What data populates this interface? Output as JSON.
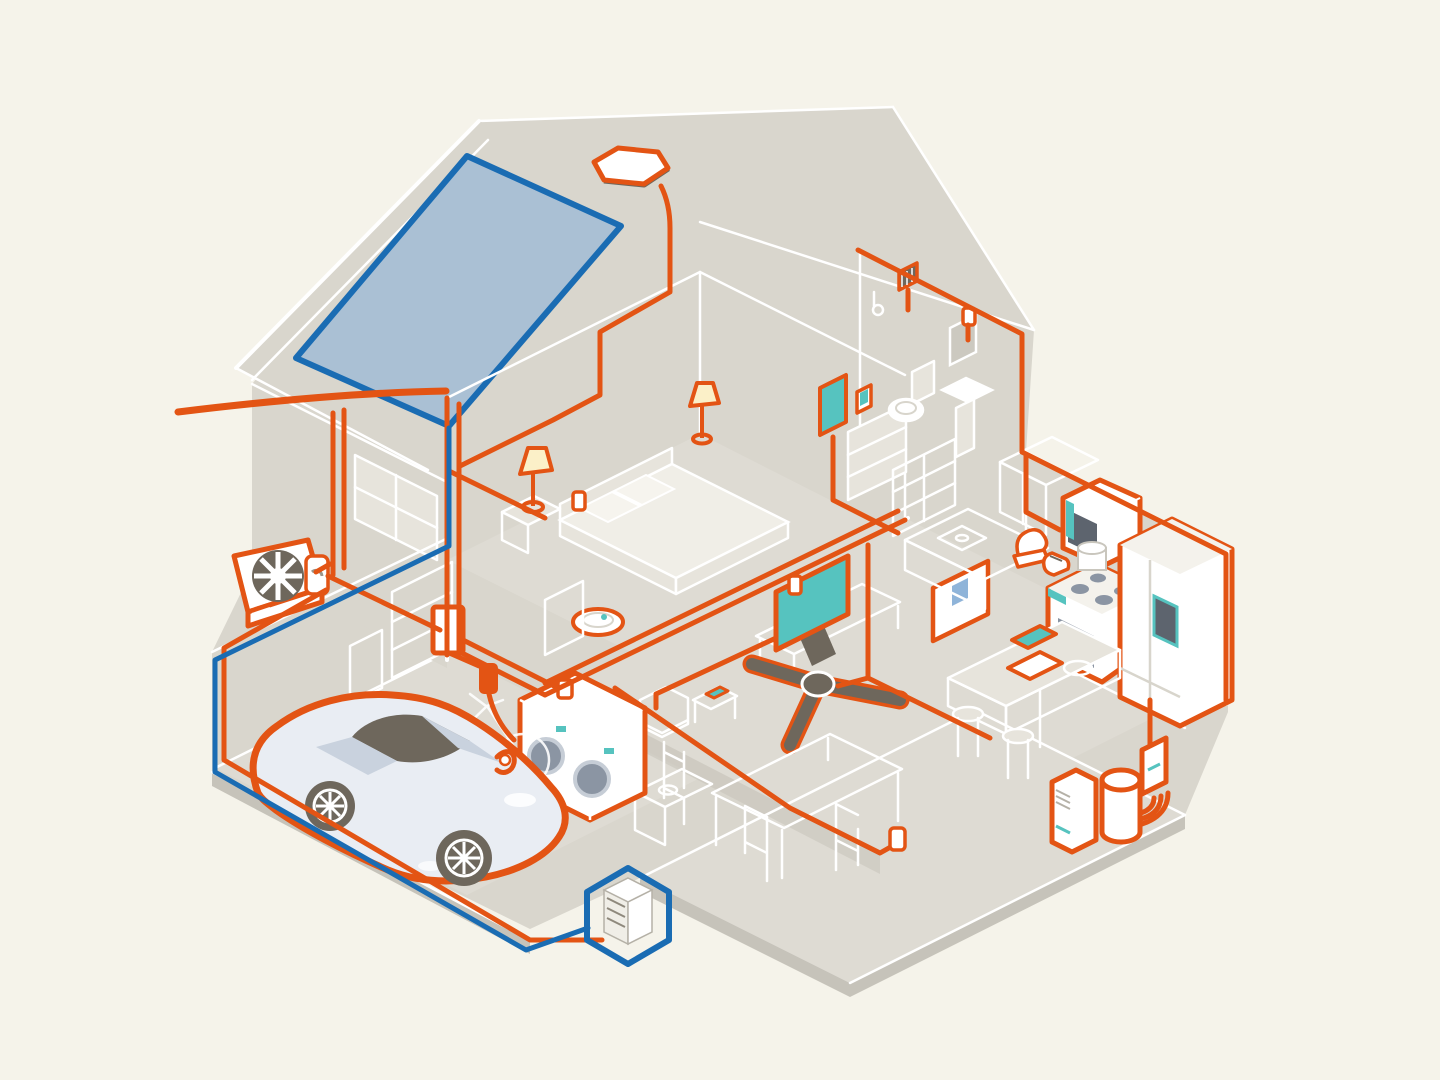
{
  "scene": {
    "title": "Isometric cutaway illustration of an all-electric home with solar panel, home battery, EV and electric appliances connected by orange wiring",
    "canvas": {
      "width": 1440,
      "height": 1080
    }
  },
  "colors": {
    "background": "#f5f3ea",
    "wall": "#d9d6cd",
    "wall_light": "#e7e4dc",
    "wall_dark": "#c6c3ba",
    "floor": "#dedbd3",
    "line_white": "#ffffff",
    "wire_orange": "#e35414",
    "orange_deep": "#d9480f",
    "wire_blue": "#1a6cb3",
    "solar_panel": "#aac0d4",
    "accent_teal": "#56c3bf",
    "lamp_glow": "#fbf0c8",
    "dark_taupe": "#6e675c",
    "metal_gray": "#8b95a3",
    "metal_light": "#c6cdd6",
    "car_body": "#e9edf3",
    "car_shade": "#c9d2de",
    "screen_gray": "#5d646e",
    "white": "#ffffff"
  },
  "components": [
    {
      "id": "solar-panel",
      "label": "rooftop solar panel"
    },
    {
      "id": "attic-fan",
      "label": "roof attic fan vent"
    },
    {
      "id": "service-line",
      "label": "incoming electric service line"
    },
    {
      "id": "electricity-meter",
      "label": "electricity meter"
    },
    {
      "id": "heat-pump",
      "label": "outdoor heat pump unit"
    },
    {
      "id": "electrical-panel",
      "label": "breaker panel"
    },
    {
      "id": "ev-charger",
      "label": "EV wall charger"
    },
    {
      "id": "ev-car",
      "label": "electric car"
    },
    {
      "id": "home-battery",
      "label": "home battery in blue hexagon"
    },
    {
      "id": "bicycle",
      "label": "bicycle"
    },
    {
      "id": "washer-dryer",
      "label": "electric washer and dryer"
    },
    {
      "id": "bed",
      "label": "bed"
    },
    {
      "id": "table-lamp-left",
      "label": "bedside lamp"
    },
    {
      "id": "table-lamp-back",
      "label": "bedside lamp"
    },
    {
      "id": "robot-vacuum",
      "label": "robot vacuum"
    },
    {
      "id": "bedroom-tv",
      "label": "wall mounted TV"
    },
    {
      "id": "bathroom-vent-fan",
      "label": "bathroom vent fan"
    },
    {
      "id": "toilet",
      "label": "toilet"
    },
    {
      "id": "bathroom-sink",
      "label": "pedestal sink"
    },
    {
      "id": "bathroom-mirror",
      "label": "mirror"
    },
    {
      "id": "wall-control",
      "label": "smart wall control"
    },
    {
      "id": "living-tv",
      "label": "living room TV"
    },
    {
      "id": "ceiling-fan",
      "label": "ceiling fan"
    },
    {
      "id": "wall-art",
      "label": "framed wall board with note"
    },
    {
      "id": "tablet",
      "label": "tablet on side table"
    },
    {
      "id": "armchair",
      "label": "armchair"
    },
    {
      "id": "dining-table",
      "label": "dining table and chairs"
    },
    {
      "id": "kitchen-counter",
      "label": "kitchen counter and sink"
    },
    {
      "id": "microwave",
      "label": "microwave oven"
    },
    {
      "id": "electric-range",
      "label": "electric range"
    },
    {
      "id": "refrigerator",
      "label": "refrigerator"
    },
    {
      "id": "stand-mixer",
      "label": "stand mixer"
    },
    {
      "id": "toaster",
      "label": "toaster"
    },
    {
      "id": "kitchen-island",
      "label": "kitchen island with stools"
    },
    {
      "id": "laptop",
      "label": "laptop"
    },
    {
      "id": "water-heater",
      "label": "heat pump water heater"
    },
    {
      "id": "sub-panel",
      "label": "basement sub panel"
    },
    {
      "id": "portable-unit",
      "label": "portable conditioning unit"
    }
  ]
}
